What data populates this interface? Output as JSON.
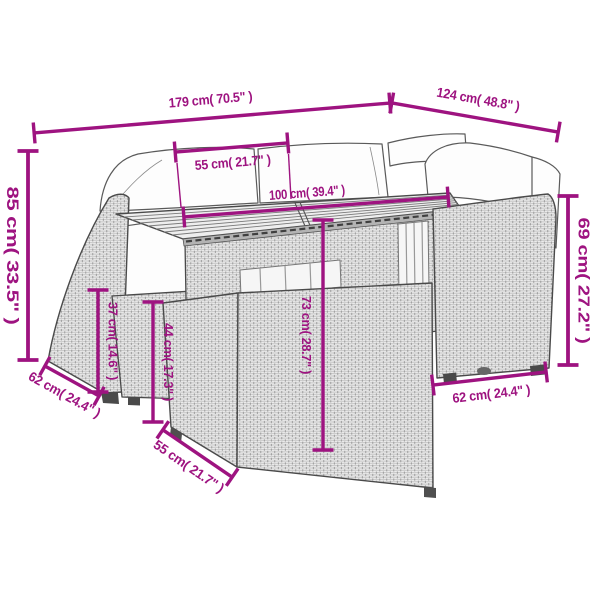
{
  "image": {
    "type": "furniture-dimension-diagram",
    "accent_color": "#9e1380",
    "outline_color": "#5a5a5a",
    "labels": {
      "width_overall": "179 cm( 70.5\" )",
      "depth_overall": "124 cm( 48.8\" )",
      "tabletop_depth": "55 cm( 21.7\" )",
      "tabletop_length": "100 cm( 39.4\" )",
      "back_height_left": "85 cm( 33.5\" )",
      "seat_height": "37 cm( 14.6\" )",
      "stool_height": "44 cm( 17.3\" )",
      "table_height": "73 cm( 28.7\" )",
      "back_height_right": "69 cm( 27.2\" )",
      "seat_depth_left": "62 cm( 24.4\" )",
      "seat_depth_right": "62 cm( 24.4\" )",
      "stool_depth": "55 cm( 21.7\" )"
    }
  }
}
